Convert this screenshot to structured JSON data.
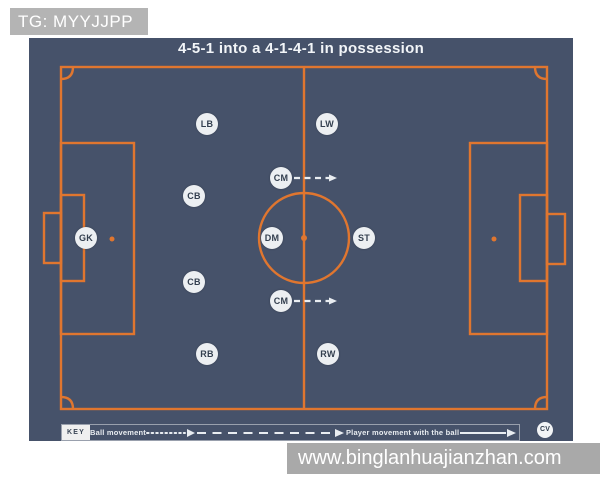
{
  "watermarks": {
    "top": "TG: MYYJJPP",
    "bottom": "www.binglanhuajianzhan.com"
  },
  "diagram": {
    "title": "4-5-1 into a 4-1-4-1 in possession",
    "colors": {
      "panel_bg": "#46526A",
      "pitch_line": "#E0762F",
      "player_bg": "#ECEFF2",
      "player_text": "#333F4F",
      "arrow": "#E9EDF1",
      "wm_top_bg": "#B4B4B4",
      "wm_bottom_bg": "#A9A9A9",
      "wm_text": "#FFFFFF"
    },
    "players": [
      {
        "label": "GK",
        "x": 86,
        "y": 238
      },
      {
        "label": "LB",
        "x": 207,
        "y": 124
      },
      {
        "label": "CB",
        "x": 194,
        "y": 196
      },
      {
        "label": "CB",
        "x": 194,
        "y": 282
      },
      {
        "label": "RB",
        "x": 207,
        "y": 354
      },
      {
        "label": "CM",
        "x": 281,
        "y": 178
      },
      {
        "label": "DM",
        "x": 272,
        "y": 238
      },
      {
        "label": "CM",
        "x": 281,
        "y": 301
      },
      {
        "label": "LW",
        "x": 327,
        "y": 124
      },
      {
        "label": "ST",
        "x": 364,
        "y": 238
      },
      {
        "label": "RW",
        "x": 328,
        "y": 354
      }
    ],
    "arrows": [
      {
        "type": "dashed",
        "x1": 294,
        "y1": 178,
        "x2": 336,
        "y2": 178
      },
      {
        "type": "dashed",
        "x1": 294,
        "y1": 301,
        "x2": 336,
        "y2": 301
      }
    ],
    "key": {
      "label": "KEY",
      "ball_movement_label": "Ball movement",
      "player_movement_with_ball_label": "Player movement with the ball",
      "badge": "CV"
    }
  }
}
